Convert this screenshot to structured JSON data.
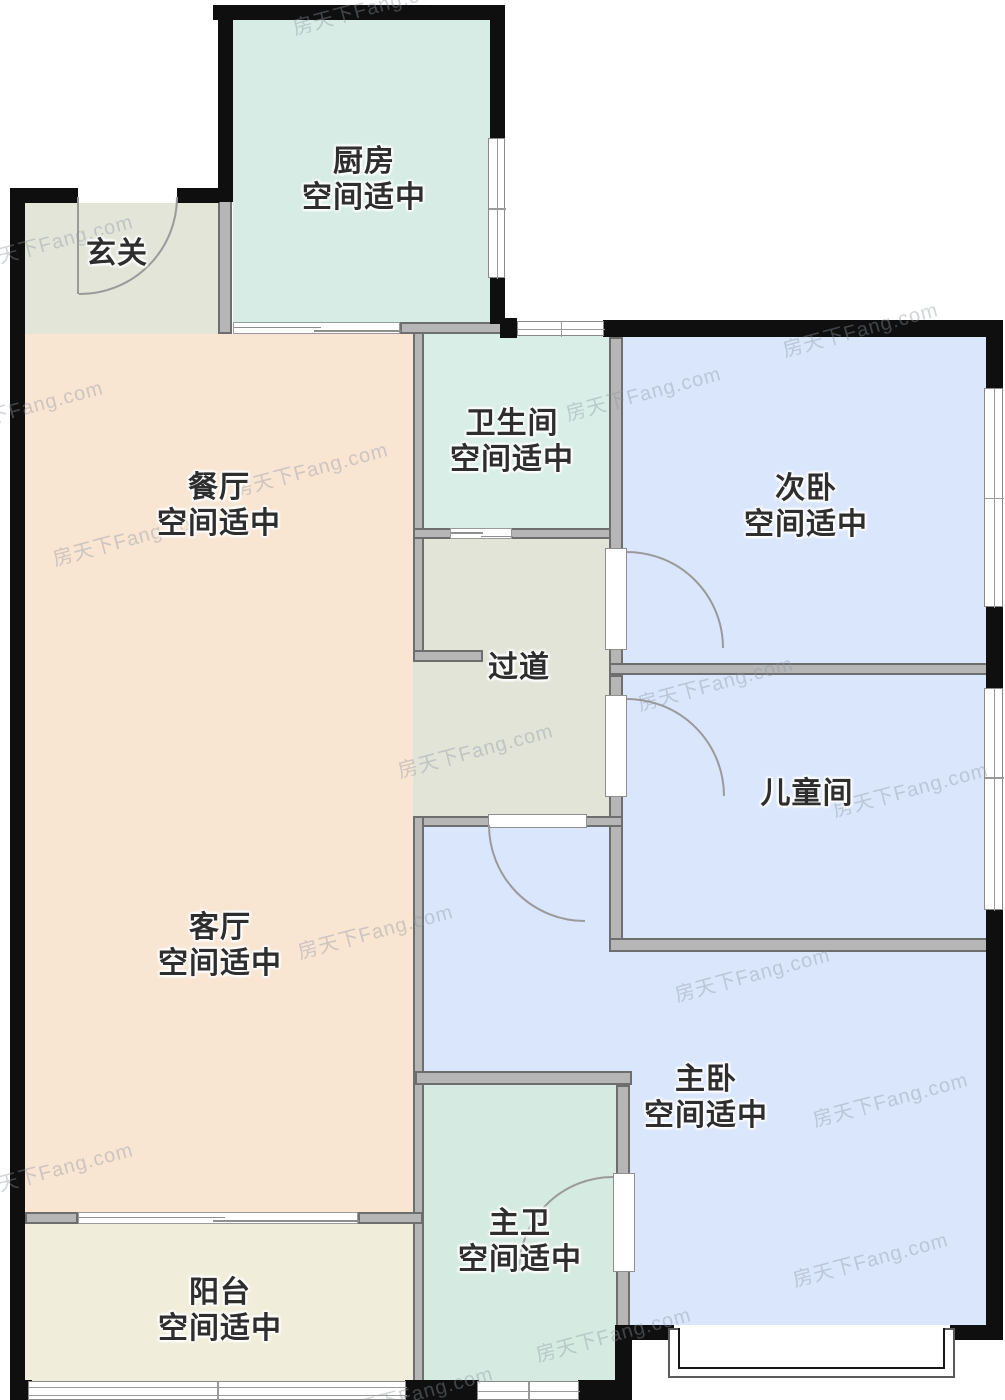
{
  "plan_title": "户型图",
  "status_text": "空间适中",
  "watermark": {
    "text": "房天下Fang.com",
    "color": "rgba(141,149,162,0.40)"
  },
  "wall_colors": {
    "exterior": "#0f0f0f",
    "interior": "#b6b6b6"
  },
  "rooms": [
    {
      "id": "entry",
      "name": "玄关",
      "two_line": false,
      "color": "#e2e5d8",
      "rect": [
        25,
        203,
        193,
        131
      ],
      "label": [
        117,
        236
      ]
    },
    {
      "id": "kitchen",
      "name": "厨房",
      "two_line": true,
      "color": "#d6ece4",
      "rect": [
        233,
        20,
        257,
        302
      ],
      "label": [
        364,
        144
      ]
    },
    {
      "id": "dining",
      "name": "餐厅",
      "two_line": true,
      "color": "#f8e5d2",
      "rect": [
        25,
        334,
        388,
        478
      ],
      "label": [
        219,
        470
      ]
    },
    {
      "id": "living",
      "name": "客厅",
      "two_line": true,
      "color": "#f8e5d2",
      "rect": [
        25,
        812,
        388,
        400
      ],
      "label": [
        220,
        910
      ]
    },
    {
      "id": "bathroom",
      "name": "卫生间",
      "two_line": true,
      "color": "#d9eee7",
      "rect": [
        423,
        334,
        186,
        194
      ],
      "label": [
        512,
        406
      ]
    },
    {
      "id": "corridor",
      "name": "过道",
      "two_line": false,
      "color": "#e3e4d8",
      "rect": [
        413,
        539,
        196,
        277
      ],
      "label": [
        519,
        650
      ]
    },
    {
      "id": "bedroom2",
      "name": "次卧",
      "two_line": true,
      "color": "#dae6fb",
      "rect": [
        622,
        337,
        364,
        326
      ],
      "label": [
        806,
        471
      ]
    },
    {
      "id": "kidsroom",
      "name": "儿童间",
      "two_line": false,
      "color": "#dae6fb",
      "rect": [
        622,
        675,
        364,
        263
      ],
      "label": [
        807,
        776
      ]
    },
    {
      "id": "master",
      "name": "主卧",
      "two_line": true,
      "color": "#dae6fb",
      "rect": [
        423,
        827,
        563,
        498
      ],
      "label": [
        706,
        1062
      ]
    },
    {
      "id": "masterbath",
      "name": "主卫",
      "two_line": true,
      "color": "#d5ebe1",
      "rect": [
        423,
        1085,
        193,
        297
      ],
      "label": [
        520,
        1206
      ]
    },
    {
      "id": "balcony",
      "name": "阳台",
      "two_line": true,
      "color": "#f0eeda",
      "rect": [
        25,
        1224,
        388,
        157
      ],
      "label": [
        220,
        1275
      ]
    }
  ]
}
